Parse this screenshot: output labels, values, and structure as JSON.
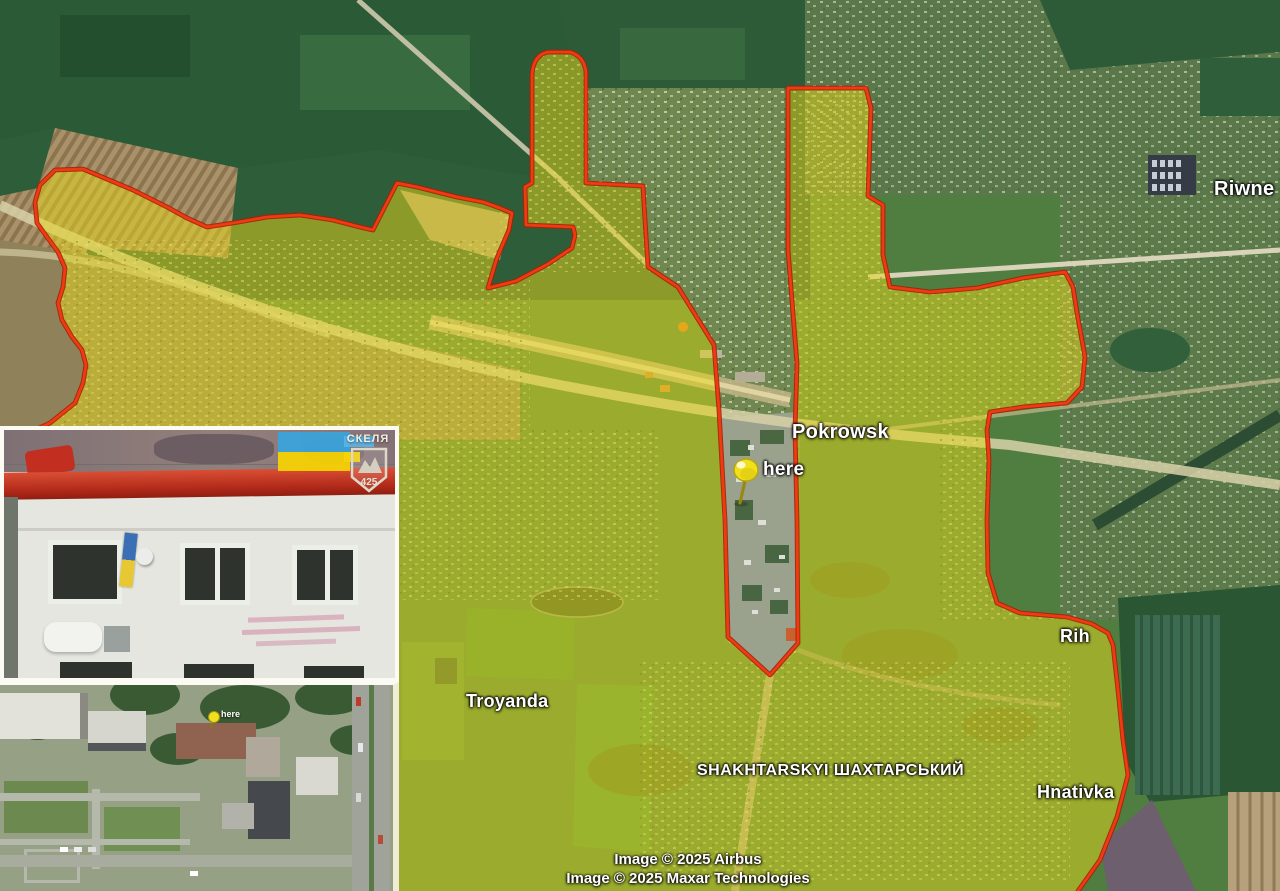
{
  "map": {
    "labels": [
      {
        "id": "riwne",
        "text": "Riwne"
      },
      {
        "id": "pokrowsk",
        "text": "Pokrowsk"
      },
      {
        "id": "here",
        "text": "here"
      },
      {
        "id": "troyanda",
        "text": "Troyanda"
      },
      {
        "id": "shakhtarskyi",
        "text": "SHAKHTARSKYI ШАХТАРСЬКИЙ"
      },
      {
        "id": "rih",
        "text": "Rih"
      },
      {
        "id": "hnativka",
        "text": "Hnativka"
      }
    ],
    "attribution": {
      "line1": "Image © 2025 Airbus",
      "line2": "Image © 2025 Maxar Technologies"
    },
    "colors": {
      "zone_fill": "#e7d81a",
      "zone_border": "#e93312",
      "pin": "#f2e01a"
    }
  },
  "insets": {
    "photo": {
      "emblem_unit": "СКЕЛЯ",
      "emblem_number": "425"
    },
    "satellite": {
      "pin_label": "here"
    }
  }
}
